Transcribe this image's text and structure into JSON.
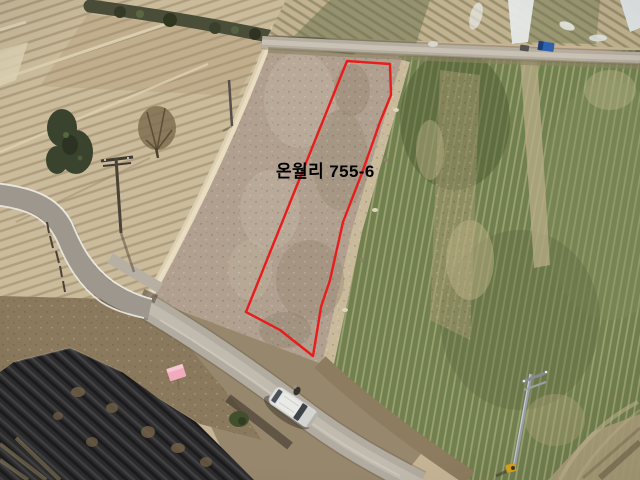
{
  "annotation": {
    "label": "온월리 755-6",
    "label_color": "#000000",
    "outline_color": "#e81c1c",
    "outline_points": "347,61 390,64 391,95 380,122 362,173 343,222 330,280 321,307 313,356 280,330 246,312"
  },
  "scene": {
    "type": "aerial-drone-photo-of-farmland",
    "colors": {
      "plowed_field_tan": "#cabb9b",
      "scrub_parcel": "#b1a08f",
      "green_crop": "#71804f",
      "asphalt_road": "#9d978e",
      "gravel_road": "#b2aba0",
      "dirt_path": "#dccfb1",
      "black_vinyl_mulch": "#2c2c2e",
      "hedge_green": "#4a4e39",
      "flag_pink": "#f2abbe",
      "truck_blue": "#2f61ae",
      "pole_marker_yellow": "#d8a31f",
      "vehicle_white": "#dfdfdc"
    }
  }
}
